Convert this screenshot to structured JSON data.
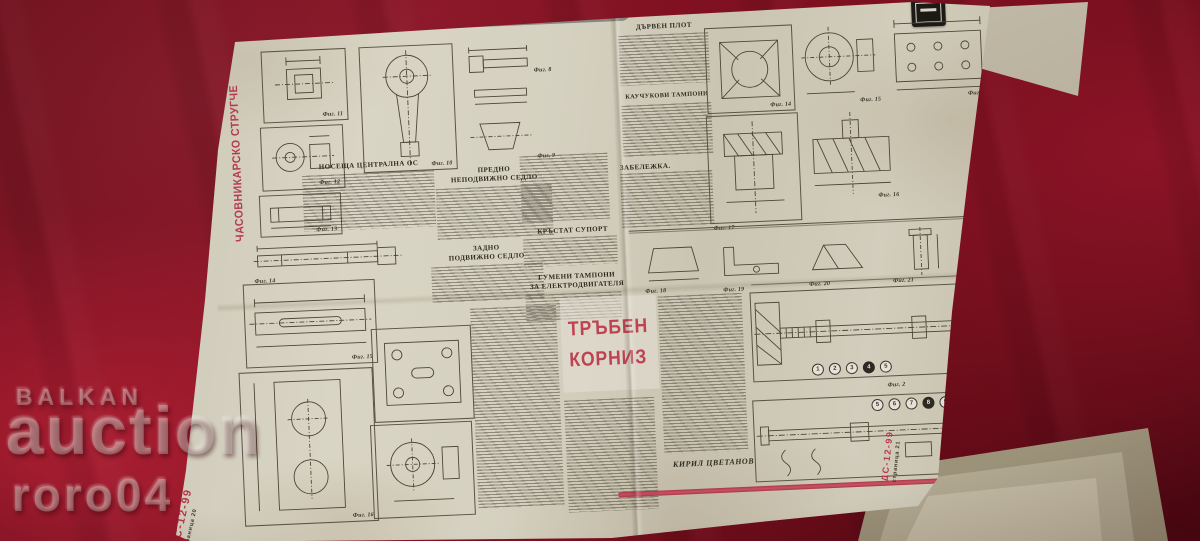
{
  "watermark": {
    "line1": "BALKAN",
    "line2": "auction",
    "line3": "roro04"
  },
  "banner": {
    "text": "Домашни професионални вести"
  },
  "left_page": {
    "vertical_title": "ЧАСОВНИКАРСКО СТРУГЧЕ",
    "headings": {
      "nosesha": "НОСЕЩА ЦЕНТРАЛНА ОС",
      "predno_1": "ПРЕДНО",
      "predno_2": "НЕПОДВИЖНО СЕДЛО",
      "zadno_1": "ЗАДНО",
      "zadno_2": "ПОДВИЖНО СЕДЛО",
      "krastat": "КРЪСТАТ СУПОРТ",
      "gumeni_1": "ГУМЕНИ ТАМПОНИ",
      "gumeni_2": "ЗА ЕЛЕКТРОДВИГАТЕЛЯ"
    },
    "marker": {
      "issue": "ДС-12-99",
      "page": "страница 20"
    }
  },
  "right_page": {
    "headings": {
      "darven": "ДЪРВЕН ПЛОТ",
      "kauchukovi": "КАУЧУКОВИ ТАМПОНИ",
      "zabelezhka": "ЗАБЕЛЕЖКА."
    },
    "marker": {
      "issue": "ДС-12-99",
      "page": "страница 21"
    }
  },
  "article": {
    "title_line1": "ТРЪБЕН",
    "title_line2": "КОРНИЗ",
    "author": "КИРИЛ ЦВЕТАНОВ"
  },
  "figure_labels": {
    "1": "Фиг. 1",
    "2": "Фиг. 2",
    "8": "Фиг. 8",
    "9": "Фиг. 9",
    "10": "Фиг. 10",
    "11": "Фиг. 11",
    "12": "Фиг. 12",
    "13": "Фиг. 13",
    "14": "Фиг. 14",
    "15": "Фиг. 15",
    "16": "Фиг. 16",
    "17": "Фиг. 17",
    "18": "Фиг. 18",
    "19": "Фиг. 19",
    "20": "Фиг. 20",
    "21": "Фиг. 21"
  },
  "callouts": {
    "fig1": [
      "1",
      "2",
      "3",
      "4",
      "5"
    ],
    "fig2": [
      "5",
      "6",
      "7",
      "8",
      "9"
    ]
  }
}
